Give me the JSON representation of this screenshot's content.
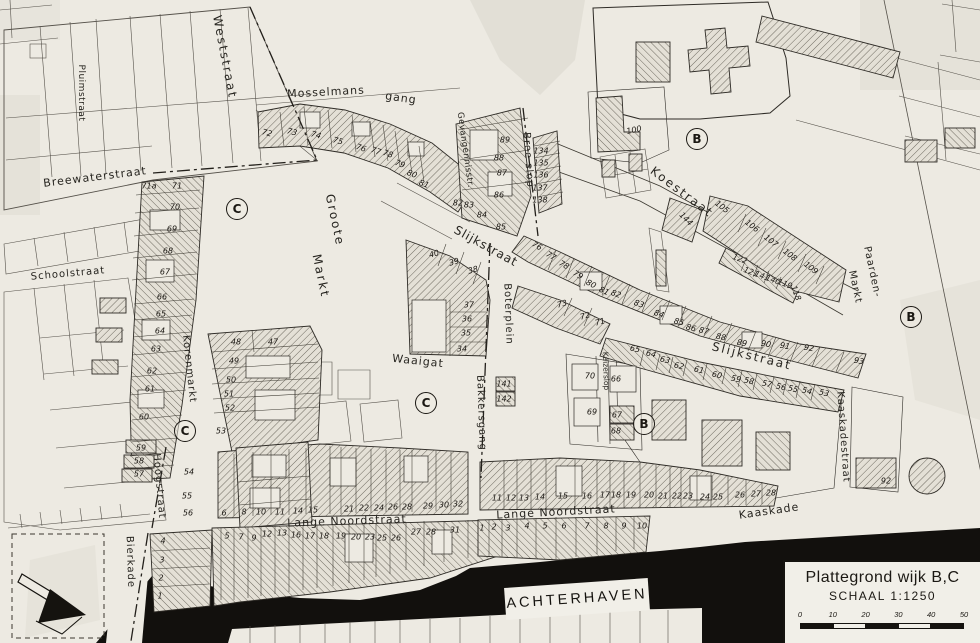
{
  "map": {
    "colors": {
      "paper": "#edeae2",
      "ink": "#26241f",
      "water": "#12100d"
    },
    "street_labels": [
      {
        "text": "Weststraat",
        "x": 225,
        "y": 57,
        "rot": 79,
        "fs": 12,
        "ls": 2
      },
      {
        "text": "Pluimstraat",
        "x": 81,
        "y": 93,
        "rot": 90,
        "fs": 9,
        "ls": 0.5
      },
      {
        "text": "Breewaterstraat",
        "x": 95,
        "y": 177,
        "rot": -7,
        "fs": 11,
        "ls": 1
      },
      {
        "text": "Schoolstraat",
        "x": 68,
        "y": 274,
        "rot": -5,
        "fs": 10,
        "ls": 1
      },
      {
        "text": "Mosselmans",
        "x": 326,
        "y": 92,
        "rot": -3,
        "fs": 11,
        "ls": 1
      },
      {
        "text": "gang",
        "x": 401,
        "y": 98,
        "rot": 8,
        "fs": 11,
        "ls": 1
      },
      {
        "text": "Gevangennisstr.",
        "x": 465,
        "y": 150,
        "rot": 82,
        "fs": 8.5,
        "ls": 0.5
      },
      {
        "text": "Bree slop",
        "x": 528,
        "y": 160,
        "rot": 86,
        "fs": 10,
        "ls": 1
      },
      {
        "text": "Koestraat",
        "x": 682,
        "y": 192,
        "rot": 37,
        "fs": 12,
        "ls": 2
      },
      {
        "text": "Slijkstraat",
        "x": 486,
        "y": 246,
        "rot": 29,
        "fs": 12,
        "ls": 1
      },
      {
        "text": "Slijkstraat",
        "x": 752,
        "y": 356,
        "rot": 14,
        "fs": 12,
        "ls": 2
      },
      {
        "text": "Groote",
        "x": 335,
        "y": 220,
        "rot": 78,
        "fs": 12,
        "ls": 2
      },
      {
        "text": "Markt",
        "x": 321,
        "y": 276,
        "rot": 78,
        "fs": 12,
        "ls": 2
      },
      {
        "text": "Waaigat",
        "x": 418,
        "y": 361,
        "rot": 6,
        "fs": 11,
        "ls": 1
      },
      {
        "text": "Boterplein",
        "x": 508,
        "y": 314,
        "rot": 88,
        "fs": 10,
        "ls": 1
      },
      {
        "text": "Bakkersgang",
        "x": 481,
        "y": 413,
        "rot": 88,
        "fs": 10,
        "ls": 1
      },
      {
        "text": "Korenmarkt",
        "x": 189,
        "y": 369,
        "rot": 84,
        "fs": 10,
        "ls": 1
      },
      {
        "text": "Kaizerslop",
        "x": 606,
        "y": 371,
        "rot": 88,
        "fs": 7.5,
        "ls": 0
      },
      {
        "text": "Hoogstraat",
        "x": 159,
        "y": 486,
        "rot": 85,
        "fs": 10,
        "ls": 1
      },
      {
        "text": "Bierkade",
        "x": 130,
        "y": 562,
        "rot": 88,
        "fs": 10,
        "ls": 1
      },
      {
        "text": "Lange Noordstraat",
        "x": 347,
        "y": 521,
        "rot": -2,
        "fs": 11,
        "ls": 1
      },
      {
        "text": "Lange Noordstraat",
        "x": 556,
        "y": 512,
        "rot": -3,
        "fs": 11,
        "ls": 1
      },
      {
        "text": "Kaaskade",
        "x": 769,
        "y": 511,
        "rot": -8,
        "fs": 11,
        "ls": 1
      },
      {
        "text": "Kaaskadestraat",
        "x": 843,
        "y": 437,
        "rot": 86,
        "fs": 10,
        "ls": 1
      },
      {
        "text": "Paarden-",
        "x": 872,
        "y": 272,
        "rot": 78,
        "fs": 10,
        "ls": 1
      },
      {
        "text": "Markt",
        "x": 855,
        "y": 287,
        "rot": 78,
        "fs": 10,
        "ls": 1
      }
    ],
    "district_markers": [
      {
        "letter": "C",
        "x": 237,
        "y": 209
      },
      {
        "letter": "B",
        "x": 697,
        "y": 139
      },
      {
        "letter": "B",
        "x": 911,
        "y": 317
      },
      {
        "letter": "C",
        "x": 185,
        "y": 431
      },
      {
        "letter": "C",
        "x": 426,
        "y": 403
      },
      {
        "letter": "B",
        "x": 644,
        "y": 424
      }
    ],
    "house_numbers": [
      {
        "t": "72",
        "x": 267,
        "y": 133,
        "r": 15
      },
      {
        "t": "73",
        "x": 292,
        "y": 132,
        "r": 15
      },
      {
        "t": "74",
        "x": 316,
        "y": 135,
        "r": 15
      },
      {
        "t": "75",
        "x": 338,
        "y": 141,
        "r": 15
      },
      {
        "t": "76",
        "x": 361,
        "y": 148,
        "r": 18
      },
      {
        "t": "77",
        "x": 376,
        "y": 151,
        "r": 18
      },
      {
        "t": "78",
        "x": 388,
        "y": 154,
        "r": 18
      },
      {
        "t": "79",
        "x": 400,
        "y": 164,
        "r": 20
      },
      {
        "t": "80",
        "x": 412,
        "y": 174,
        "r": 20
      },
      {
        "t": "81",
        "x": 424,
        "y": 184,
        "r": 20
      },
      {
        "t": "89",
        "x": 505,
        "y": 140,
        "r": 0
      },
      {
        "t": "88",
        "x": 499,
        "y": 158,
        "r": 0
      },
      {
        "t": "87",
        "x": 502,
        "y": 173,
        "r": 0
      },
      {
        "t": "86",
        "x": 499,
        "y": 195,
        "r": 0
      },
      {
        "t": "85",
        "x": 501,
        "y": 227,
        "r": 0
      },
      {
        "t": "84",
        "x": 482,
        "y": 215,
        "r": 0
      },
      {
        "t": "83",
        "x": 469,
        "y": 205,
        "r": 0
      },
      {
        "t": "82",
        "x": 458,
        "y": 203,
        "r": 0
      },
      {
        "t": "134",
        "x": 541,
        "y": 151,
        "r": 0
      },
      {
        "t": "135",
        "x": 541,
        "y": 163,
        "r": 0
      },
      {
        "t": "136",
        "x": 541,
        "y": 175,
        "r": 0
      },
      {
        "t": "137",
        "x": 540,
        "y": 188,
        "r": 0
      },
      {
        "t": "138",
        "x": 540,
        "y": 200,
        "r": 0
      },
      {
        "t": "100",
        "x": 634,
        "y": 130,
        "r": -12
      },
      {
        "t": "105",
        "x": 722,
        "y": 207,
        "r": 38
      },
      {
        "t": "106",
        "x": 752,
        "y": 226,
        "r": 38
      },
      {
        "t": "107",
        "x": 771,
        "y": 241,
        "r": 38
      },
      {
        "t": "108",
        "x": 790,
        "y": 255,
        "r": 38
      },
      {
        "t": "109",
        "x": 811,
        "y": 268,
        "r": 38
      },
      {
        "t": "144",
        "x": 686,
        "y": 219,
        "r": 45
      },
      {
        "t": "122",
        "x": 740,
        "y": 259,
        "r": 20
      },
      {
        "t": "121",
        "x": 751,
        "y": 272,
        "r": 20
      },
      {
        "t": "141",
        "x": 762,
        "y": 276,
        "r": 20
      },
      {
        "t": "140",
        "x": 773,
        "y": 280,
        "r": 20
      },
      {
        "t": "119",
        "x": 785,
        "y": 284,
        "r": 20
      },
      {
        "t": "118",
        "x": 796,
        "y": 293,
        "r": 70
      },
      {
        "t": "76",
        "x": 537,
        "y": 246,
        "r": 30
      },
      {
        "t": "77",
        "x": 551,
        "y": 256,
        "r": 30
      },
      {
        "t": "78",
        "x": 564,
        "y": 265,
        "r": 30
      },
      {
        "t": "79",
        "x": 578,
        "y": 275,
        "r": 30
      },
      {
        "t": "80",
        "x": 591,
        "y": 284,
        "r": 28
      },
      {
        "t": "81",
        "x": 604,
        "y": 291,
        "r": 25
      },
      {
        "t": "82",
        "x": 616,
        "y": 294,
        "r": 20
      },
      {
        "t": "83",
        "x": 639,
        "y": 304,
        "r": 18
      },
      {
        "t": "84",
        "x": 659,
        "y": 314,
        "r": 18
      },
      {
        "t": "85",
        "x": 679,
        "y": 322,
        "r": 15
      },
      {
        "t": "86",
        "x": 691,
        "y": 328,
        "r": 15
      },
      {
        "t": "87",
        "x": 704,
        "y": 331,
        "r": 15
      },
      {
        "t": "88",
        "x": 721,
        "y": 337,
        "r": 12
      },
      {
        "t": "89",
        "x": 742,
        "y": 343,
        "r": 10
      },
      {
        "t": "90",
        "x": 766,
        "y": 344,
        "r": 10
      },
      {
        "t": "91",
        "x": 785,
        "y": 346,
        "r": 10
      },
      {
        "t": "92",
        "x": 809,
        "y": 348,
        "r": 10
      },
      {
        "t": "93",
        "x": 859,
        "y": 361,
        "r": 10
      },
      {
        "t": "65",
        "x": 635,
        "y": 349,
        "r": 12
      },
      {
        "t": "64",
        "x": 651,
        "y": 354,
        "r": 12
      },
      {
        "t": "63",
        "x": 665,
        "y": 360,
        "r": 12
      },
      {
        "t": "62",
        "x": 679,
        "y": 366,
        "r": 12
      },
      {
        "t": "61",
        "x": 699,
        "y": 370,
        "r": 12
      },
      {
        "t": "60",
        "x": 717,
        "y": 375,
        "r": 12
      },
      {
        "t": "59",
        "x": 736,
        "y": 379,
        "r": 12
      },
      {
        "t": "58",
        "x": 749,
        "y": 381,
        "r": 12
      },
      {
        "t": "57",
        "x": 767,
        "y": 384,
        "r": 12
      },
      {
        "t": "56",
        "x": 781,
        "y": 387,
        "r": 12
      },
      {
        "t": "55",
        "x": 793,
        "y": 389,
        "r": 12
      },
      {
        "t": "54",
        "x": 807,
        "y": 391,
        "r": 12
      },
      {
        "t": "53",
        "x": 824,
        "y": 393,
        "r": 12
      },
      {
        "t": "70",
        "x": 590,
        "y": 376,
        "r": 0
      },
      {
        "t": "66",
        "x": 616,
        "y": 379,
        "r": 0
      },
      {
        "t": "69",
        "x": 592,
        "y": 412,
        "r": 0
      },
      {
        "t": "67",
        "x": 617,
        "y": 415,
        "r": 0
      },
      {
        "t": "68",
        "x": 616,
        "y": 431,
        "r": 0
      },
      {
        "t": "73",
        "x": 562,
        "y": 304,
        "r": -15
      },
      {
        "t": "72",
        "x": 585,
        "y": 316,
        "r": -15
      },
      {
        "t": "71",
        "x": 600,
        "y": 322,
        "r": -15
      },
      {
        "t": "141",
        "x": 504,
        "y": 384,
        "r": 0
      },
      {
        "t": "142",
        "x": 504,
        "y": 399,
        "r": 0
      },
      {
        "t": "40",
        "x": 434,
        "y": 254,
        "r": -15
      },
      {
        "t": "39",
        "x": 454,
        "y": 262,
        "r": -15
      },
      {
        "t": "38",
        "x": 473,
        "y": 270,
        "r": -15
      },
      {
        "t": "37",
        "x": 469,
        "y": 305,
        "r": 0
      },
      {
        "t": "36",
        "x": 467,
        "y": 319,
        "r": 0
      },
      {
        "t": "35",
        "x": 466,
        "y": 333,
        "r": 0
      },
      {
        "t": "34",
        "x": 462,
        "y": 349,
        "r": 0
      },
      {
        "t": "71a",
        "x": 149,
        "y": 186,
        "r": 0
      },
      {
        "t": "71",
        "x": 177,
        "y": 186,
        "r": 0
      },
      {
        "t": "70",
        "x": 175,
        "y": 207,
        "r": 0
      },
      {
        "t": "69",
        "x": 172,
        "y": 229,
        "r": 0
      },
      {
        "t": "68",
        "x": 168,
        "y": 251,
        "r": 0
      },
      {
        "t": "67",
        "x": 165,
        "y": 272,
        "r": 0
      },
      {
        "t": "66",
        "x": 162,
        "y": 297,
        "r": 0
      },
      {
        "t": "65",
        "x": 161,
        "y": 314,
        "r": 0
      },
      {
        "t": "64",
        "x": 160,
        "y": 331,
        "r": 0
      },
      {
        "t": "63",
        "x": 156,
        "y": 349,
        "r": 0
      },
      {
        "t": "62",
        "x": 152,
        "y": 371,
        "r": 0
      },
      {
        "t": "61",
        "x": 150,
        "y": 389,
        "r": 0
      },
      {
        "t": "60",
        "x": 144,
        "y": 417,
        "r": 0
      },
      {
        "t": "59",
        "x": 141,
        "y": 448,
        "r": 0
      },
      {
        "t": "58",
        "x": 139,
        "y": 461,
        "r": 0
      },
      {
        "t": "57",
        "x": 139,
        "y": 474,
        "r": 0
      },
      {
        "t": "48",
        "x": 236,
        "y": 342,
        "r": 0
      },
      {
        "t": "47",
        "x": 273,
        "y": 342,
        "r": 0
      },
      {
        "t": "49",
        "x": 234,
        "y": 361,
        "r": 0
      },
      {
        "t": "50",
        "x": 231,
        "y": 380,
        "r": 0
      },
      {
        "t": "51",
        "x": 229,
        "y": 394,
        "r": 0
      },
      {
        "t": "52",
        "x": 230,
        "y": 408,
        "r": 0
      },
      {
        "t": "53",
        "x": 221,
        "y": 431,
        "r": 0
      },
      {
        "t": "54",
        "x": 189,
        "y": 472,
        "r": 0
      },
      {
        "t": "55",
        "x": 187,
        "y": 496,
        "r": 0
      },
      {
        "t": "56",
        "x": 188,
        "y": 513,
        "r": 0
      },
      {
        "t": "4",
        "x": 163,
        "y": 541,
        "r": 0
      },
      {
        "t": "3",
        "x": 162,
        "y": 560,
        "r": 0
      },
      {
        "t": "2",
        "x": 161,
        "y": 578,
        "r": 0
      },
      {
        "t": "1",
        "x": 160,
        "y": 596,
        "r": 0
      },
      {
        "t": "6",
        "x": 224,
        "y": 513,
        "r": 0
      },
      {
        "t": "8",
        "x": 244,
        "y": 512,
        "r": 0
      },
      {
        "t": "10",
        "x": 261,
        "y": 512,
        "r": 0
      },
      {
        "t": "11",
        "x": 280,
        "y": 512,
        "r": 0
      },
      {
        "t": "14",
        "x": 298,
        "y": 511,
        "r": 0
      },
      {
        "t": "15",
        "x": 313,
        "y": 510,
        "r": 0
      },
      {
        "t": "21",
        "x": 349,
        "y": 509,
        "r": 0
      },
      {
        "t": "22",
        "x": 364,
        "y": 508,
        "r": 0
      },
      {
        "t": "24",
        "x": 379,
        "y": 508,
        "r": 0
      },
      {
        "t": "26",
        "x": 393,
        "y": 507,
        "r": 0
      },
      {
        "t": "28",
        "x": 407,
        "y": 507,
        "r": 0
      },
      {
        "t": "29",
        "x": 428,
        "y": 506,
        "r": 0
      },
      {
        "t": "30",
        "x": 444,
        "y": 505,
        "r": 0
      },
      {
        "t": "32",
        "x": 458,
        "y": 504,
        "r": 0
      },
      {
        "t": "5",
        "x": 227,
        "y": 536,
        "r": 0
      },
      {
        "t": "7",
        "x": 241,
        "y": 537,
        "r": 0
      },
      {
        "t": "9",
        "x": 254,
        "y": 538,
        "r": 0
      },
      {
        "t": "12",
        "x": 267,
        "y": 534,
        "r": 0
      },
      {
        "t": "13",
        "x": 282,
        "y": 533,
        "r": 0
      },
      {
        "t": "16",
        "x": 296,
        "y": 535,
        "r": 0
      },
      {
        "t": "17",
        "x": 310,
        "y": 536,
        "r": 0
      },
      {
        "t": "18",
        "x": 324,
        "y": 536,
        "r": 0
      },
      {
        "t": "19",
        "x": 341,
        "y": 536,
        "r": 0
      },
      {
        "t": "20",
        "x": 356,
        "y": 537,
        "r": 0
      },
      {
        "t": "23",
        "x": 370,
        "y": 537,
        "r": 0
      },
      {
        "t": "25",
        "x": 382,
        "y": 538,
        "r": 0
      },
      {
        "t": "26",
        "x": 396,
        "y": 538,
        "r": 0
      },
      {
        "t": "27",
        "x": 416,
        "y": 532,
        "r": 0
      },
      {
        "t": "28",
        "x": 431,
        "y": 532,
        "r": 0
      },
      {
        "t": "31",
        "x": 455,
        "y": 530,
        "r": 0
      },
      {
        "t": "11",
        "x": 497,
        "y": 498,
        "r": 0
      },
      {
        "t": "12",
        "x": 511,
        "y": 498,
        "r": 0
      },
      {
        "t": "13",
        "x": 524,
        "y": 498,
        "r": 0
      },
      {
        "t": "14",
        "x": 540,
        "y": 497,
        "r": 0
      },
      {
        "t": "15",
        "x": 563,
        "y": 496,
        "r": 0
      },
      {
        "t": "16",
        "x": 587,
        "y": 496,
        "r": 0
      },
      {
        "t": "17",
        "x": 605,
        "y": 495,
        "r": 0
      },
      {
        "t": "18",
        "x": 616,
        "y": 495,
        "r": 0
      },
      {
        "t": "19",
        "x": 631,
        "y": 495,
        "r": 0
      },
      {
        "t": "20",
        "x": 649,
        "y": 495,
        "r": 0
      },
      {
        "t": "21",
        "x": 663,
        "y": 496,
        "r": 0
      },
      {
        "t": "22",
        "x": 677,
        "y": 496,
        "r": 0
      },
      {
        "t": "23",
        "x": 688,
        "y": 496,
        "r": 0
      },
      {
        "t": "24",
        "x": 705,
        "y": 497,
        "r": 0
      },
      {
        "t": "25",
        "x": 718,
        "y": 497,
        "r": 0
      },
      {
        "t": "26",
        "x": 740,
        "y": 495,
        "r": 0
      },
      {
        "t": "27",
        "x": 756,
        "y": 494,
        "r": 0
      },
      {
        "t": "28",
        "x": 771,
        "y": 493,
        "r": 0
      },
      {
        "t": "1",
        "x": 482,
        "y": 528,
        "r": 0
      },
      {
        "t": "2",
        "x": 494,
        "y": 527,
        "r": 0
      },
      {
        "t": "3",
        "x": 508,
        "y": 528,
        "r": 0
      },
      {
        "t": "4",
        "x": 527,
        "y": 526,
        "r": 0
      },
      {
        "t": "5",
        "x": 545,
        "y": 526,
        "r": 0
      },
      {
        "t": "6",
        "x": 564,
        "y": 526,
        "r": 0
      },
      {
        "t": "7",
        "x": 587,
        "y": 526,
        "r": 0
      },
      {
        "t": "8",
        "x": 606,
        "y": 526,
        "r": 0
      },
      {
        "t": "9",
        "x": 624,
        "y": 526,
        "r": 0
      },
      {
        "t": "10",
        "x": 642,
        "y": 526,
        "r": 0
      },
      {
        "t": "92",
        "x": 886,
        "y": 481,
        "r": 0
      }
    ],
    "water_label": {
      "text": "ACHTERHAVEN"
    },
    "title_block": {
      "title": "Plattegrond wijk B,C",
      "scale_label": "SCHAAL 1:1250",
      "scale_ticks": [
        "0",
        "10",
        "20",
        "30",
        "40",
        "50"
      ]
    }
  }
}
